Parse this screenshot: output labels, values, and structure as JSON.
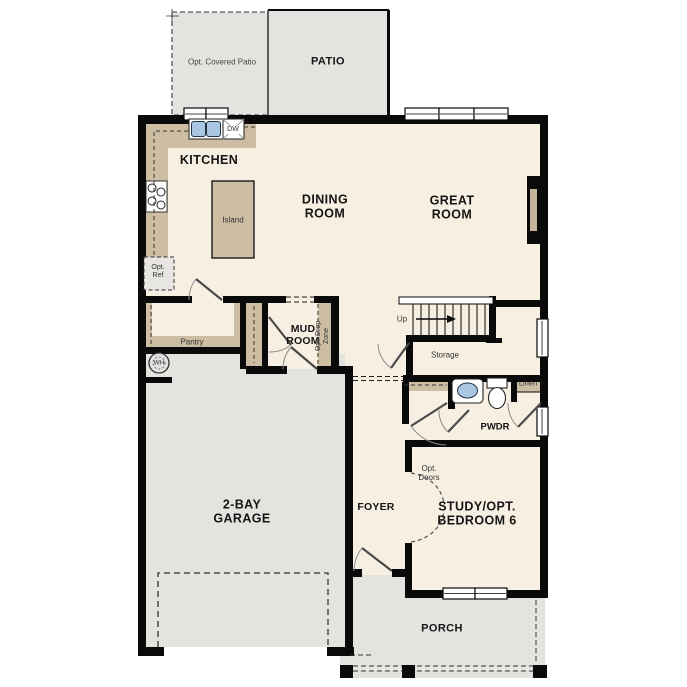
{
  "plan": {
    "title": "First Floor Plan",
    "labels": {
      "opt_covered_patio": "Opt. Covered Patio",
      "patio": "PATIO",
      "kitchen": "KITCHEN",
      "island": "Island",
      "dining_room": "DINING\nROOM",
      "great_room": "GREAT\nROOM",
      "opt_ref": "Opt.\nRef",
      "dw": "DW",
      "pantry": "Pantry",
      "mud_room": "MUD\nROOM",
      "opt_drop_zone": "Opt. Drop\nZone",
      "up": "Up",
      "storage": "Storage",
      "wh": "WH",
      "garage": "2-BAY\nGARAGE",
      "foyer": "FOYER",
      "pwdr": "PWDR",
      "linen": "Linen",
      "opt_doors": "Opt.\nDoors",
      "study": "STUDY/OPT.\nBEDROOM 6",
      "porch": "PORCH"
    },
    "colors": {
      "floor": "#f7efe1",
      "outdoor_gray": "#e3e3e0",
      "counter_tan": "#ccbda3",
      "wall_black": "#0a0a0a",
      "sink_blue": "#a9c7e3",
      "opt_ref_gray": "#e8e6e2"
    }
  }
}
